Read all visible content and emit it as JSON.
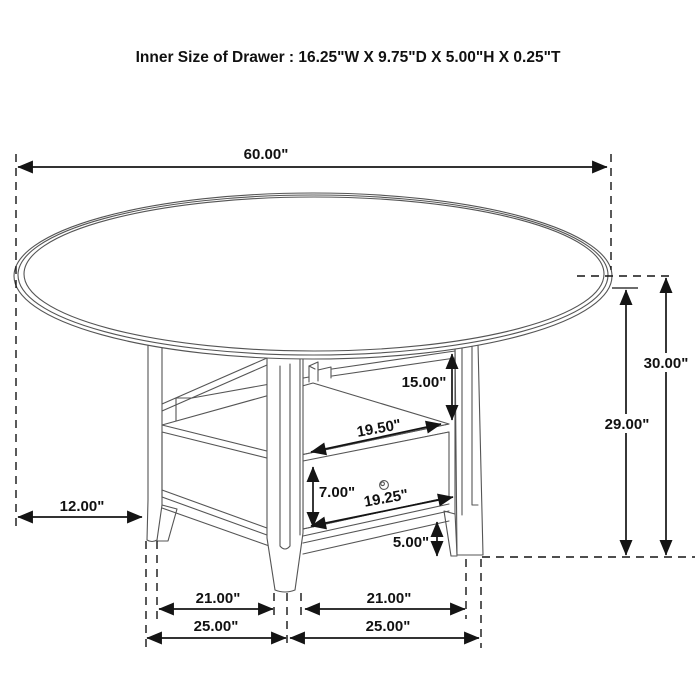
{
  "title": "Inner Size of Drawer : 16.25\"W X 9.75\"D X 5.00\"H X 0.25\"T",
  "diagram": {
    "subject": "Round dining table with pedestal storage base and drawer",
    "dimensions": {
      "diameter": "60.00\"",
      "overall_height": "30.00\"",
      "underside_height": "29.00\"",
      "top_to_shelf": "15.00\"",
      "shelf_width": "19.50\"",
      "drawer_height": "7.00\"",
      "drawer_width": "19.25\"",
      "base_height": "5.00\"",
      "top_overhang": "12.00\"",
      "inner_span_left": "21.00\"",
      "inner_span_right": "21.00\"",
      "outer_span_left": "25.00\"",
      "outer_span_right": "25.00\""
    }
  }
}
